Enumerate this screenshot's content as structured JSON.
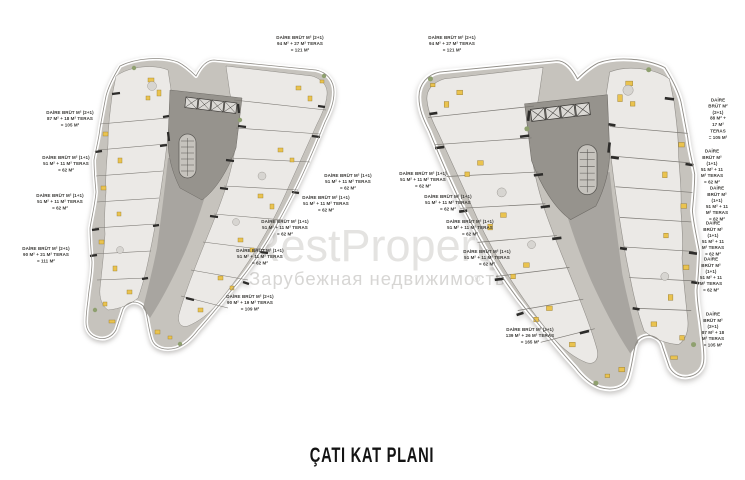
{
  "caption": {
    "text": "ÇATI KAT PLANI"
  },
  "watermark": {
    "brand": "RestProperty",
    "registered_mark": "®",
    "subtitle": "Зарубежная недвижимость"
  },
  "plans": {
    "left": {
      "name": "left block roof plan",
      "labels": [
        {
          "text": "DAİRE BRÜT M² (2+1)\n94 M² + 27 M² TERAS\n= 121 M²"
        },
        {
          "text": "DAİRE BRÜT M² (2+1)\n87 M² + 18 M² TERAS\n= 105 M²"
        },
        {
          "text": "DAİRE BRÜT M² (1+1)\n51 M² + 11 M² TERAS\n= 62 M²"
        },
        {
          "text": "DAİRE BRÜT M² (1+1)\n51 M² + 11 M² TERAS\n= 62 M²"
        },
        {
          "text": "DAİRE BRÜT M² (2+1)\n90 M² + 21 M² TERAS\n= 111 M²"
        },
        {
          "text": "DAİRE BRÜT M² (1+1)\n51 M² + 11 M² TERAS\n= 62 M²"
        },
        {
          "text": "DAİRE BRÜT M² (1+1)\n51 M² + 11 M² TERAS\n= 62 M²"
        },
        {
          "text": "DAİRE BRÜT M² (1+1)\n51 M² + 11 M² TERAS\n= 62 M²"
        },
        {
          "text": "DAİRE BRÜT M² (1+1)\n51 M² + 11 M² TERAS\n= 62 M²"
        },
        {
          "text": "DAİRE BRÜT M² (2+1)\n90 M² + 19 M² TERAS\n= 109 M²"
        }
      ]
    },
    "right": {
      "name": "right block roof plan",
      "labels": [
        {
          "text": "DAİRE BRÜT M² (2+1)\n94 M² + 27 M² TERAS\n= 121 M²"
        },
        {
          "text": "DAİRE BRÜT M² (2+1)\n88 M² + 17 M² TERAS\n= 105 M²"
        },
        {
          "text": "DAİRE BRÜT M² (1+1)\n51 M² + 11 M² TERAS\n= 62 M²"
        },
        {
          "text": "DAİRE BRÜT M² (1+1)\n51 M² + 11 M² TERAS\n= 62 M²"
        },
        {
          "text": "DAİRE BRÜT M² (1+1)\n51 M² + 11 M² TERAS\n= 62 M²"
        },
        {
          "text": "DAİRE BRÜT M² (1+1)\n51 M² + 11 M² TERAS\n= 62 M²"
        },
        {
          "text": "DAİRE BRÜT M² (1+1)\n51 M² + 11 M² TERAS\n= 62 M²"
        },
        {
          "text": "DAİRE BRÜT M² (1+1)\n51 M² + 11 M² TERAS\n= 62 M²"
        },
        {
          "text": "DAİRE BRÜT M² (1+1)\n51 M² + 11 M² TERAS\n= 62 M²"
        },
        {
          "text": "DAİRE BRÜT M² (1+1)\n51 M² + 11 M² TERAS\n= 62 M²"
        },
        {
          "text": "DAİRE BRÜT M² (2+1)\n87 M² + 18 M² TERAS\n= 105 M²"
        },
        {
          "text": "DAİRE BRÜT M² (3+1)\n139 M² + 26 M² TERAS\n= 165 M²"
        }
      ]
    }
  },
  "palette": {
    "terrace_gray": "#c6c3bd",
    "room_light": "#ebe9e6",
    "core_gray": "#96938d",
    "corridor_gray": "#a8a5a0",
    "wall_dark": "#2d2c2a",
    "furniture_yellow": "#eac34f",
    "plant_green": "#8fa06f",
    "watermark_gray": "#e4e3e1",
    "label_text": "#3a3936"
  }
}
